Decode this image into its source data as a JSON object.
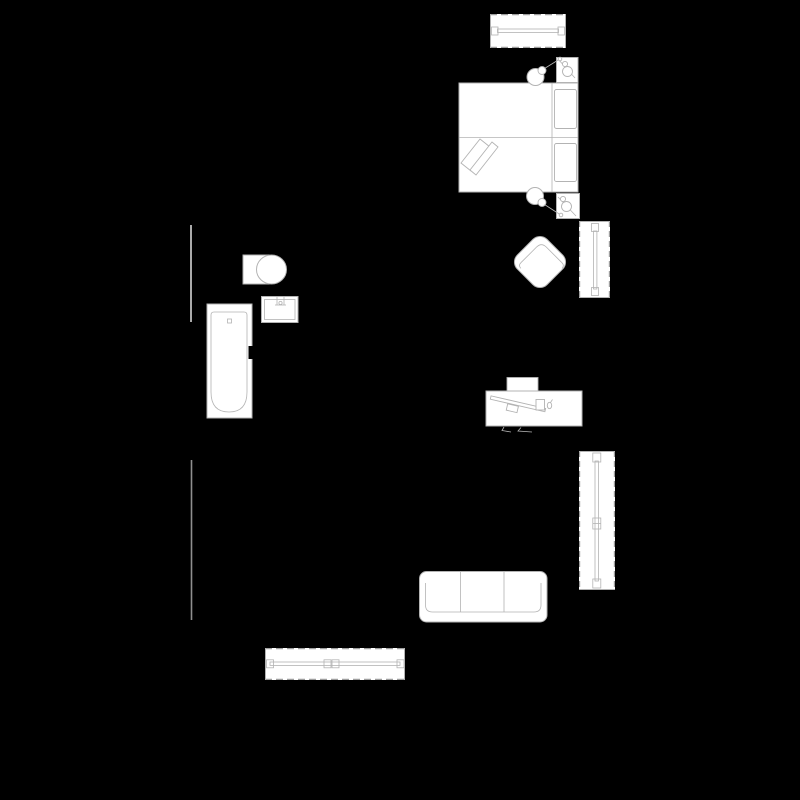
{
  "canvas": {
    "width": 800,
    "height": 800,
    "background": "#000000"
  },
  "palette": {
    "fill": "#ffffff",
    "outline": "#b3b3b3",
    "outline_dim": "#8f8f8f",
    "dash": "#9e9e9e",
    "wall": "#d4d4d4",
    "ink": "#000000"
  },
  "plan": {
    "description": "Apartment floor plan, white line furniture symbols on black background, no text labels",
    "walls": [
      {
        "id": "wall-upper-left",
        "label": "Wall segment, upper left"
      },
      {
        "id": "wall-lower-left",
        "label": "Wall segment, lower left"
      }
    ],
    "windows": [
      {
        "id": "window-top",
        "label": "Window, top horizontal, above bed"
      },
      {
        "id": "window-right-upper",
        "label": "Window, right side, beside armchair"
      },
      {
        "id": "window-right-tall",
        "label": "Tall window, right side, beside sofa"
      },
      {
        "id": "window-bottom",
        "label": "Window, bottom horizontal"
      }
    ],
    "furniture": [
      {
        "id": "double-bed",
        "label": "Double bed with two pillows and folded blanket corner"
      },
      {
        "id": "nightstand-upper",
        "label": "Nightstand with table lamp, upper side of bed"
      },
      {
        "id": "nightstand-lower",
        "label": "Nightstand with table lamp, lower side of bed"
      },
      {
        "id": "bedside-lamp-upper",
        "label": "Bedside floor lamp, upper"
      },
      {
        "id": "bedside-lamp-lower",
        "label": "Bedside floor lamp, lower"
      },
      {
        "id": "toilet",
        "label": "Toilet with cistern"
      },
      {
        "id": "sink",
        "label": "Bathroom washbasin with faucet"
      },
      {
        "id": "bathtub",
        "label": "Bathtub with drain and black mixer tap"
      },
      {
        "id": "armchair",
        "label": "Armchair rotated 45 degrees"
      },
      {
        "id": "desk",
        "label": "Desk with tucked chair, keyboard, monitor and mouse"
      },
      {
        "id": "sofa",
        "label": "Three-seat sofa"
      }
    ]
  }
}
